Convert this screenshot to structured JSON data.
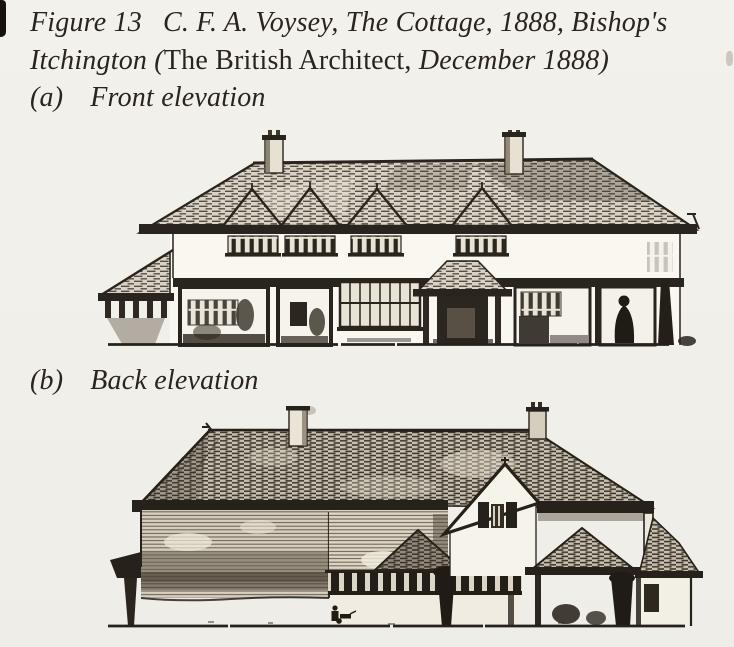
{
  "page": {
    "paper_color": "#f1efe9",
    "ink_color": "#2a241d"
  },
  "caption": {
    "figure_label": "Figure 13",
    "line1_rest": "C. F. A. Voysey, The Cottage, 1888, Bishop's",
    "line2_italic1": "Itchington (",
    "line2_roman": "The British Architect,",
    "line2_italic2": " December 1888)"
  },
  "figures": [
    {
      "index": "(a)",
      "title": "Front elevation",
      "drawing": "front-elevation-engraving"
    },
    {
      "index": "(b)",
      "title": "Back elevation",
      "drawing": "back-elevation-engraving"
    }
  ]
}
